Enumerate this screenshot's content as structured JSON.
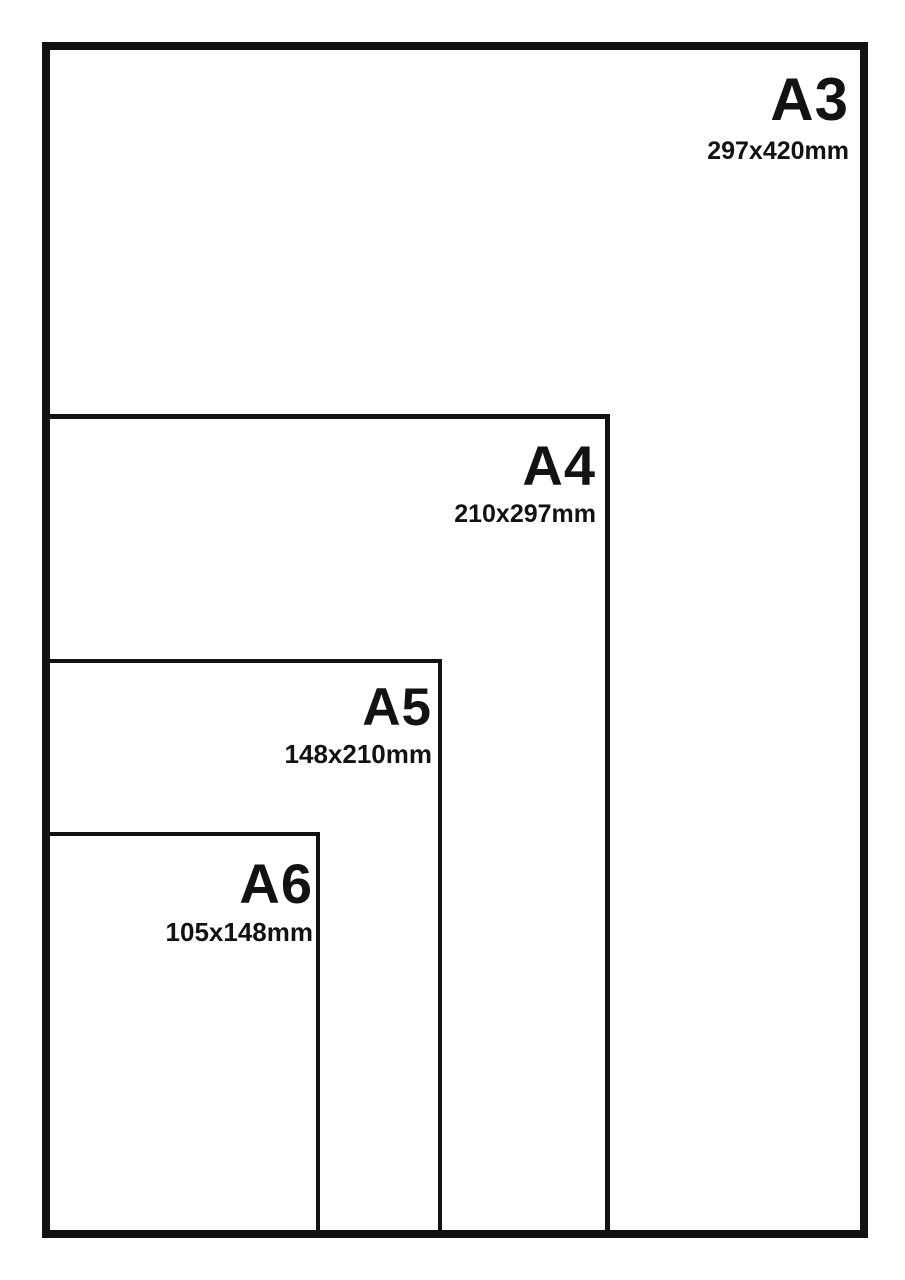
{
  "colors": {
    "background": "#ffffff",
    "line": "#121212",
    "text": "#121212"
  },
  "sizes": [
    {
      "label": "A3",
      "dimensions": "297x420mm"
    },
    {
      "label": "A4",
      "dimensions": "210x297mm"
    },
    {
      "label": "A5",
      "dimensions": "148x210mm"
    },
    {
      "label": "A6",
      "dimensions": "105x148mm"
    }
  ]
}
